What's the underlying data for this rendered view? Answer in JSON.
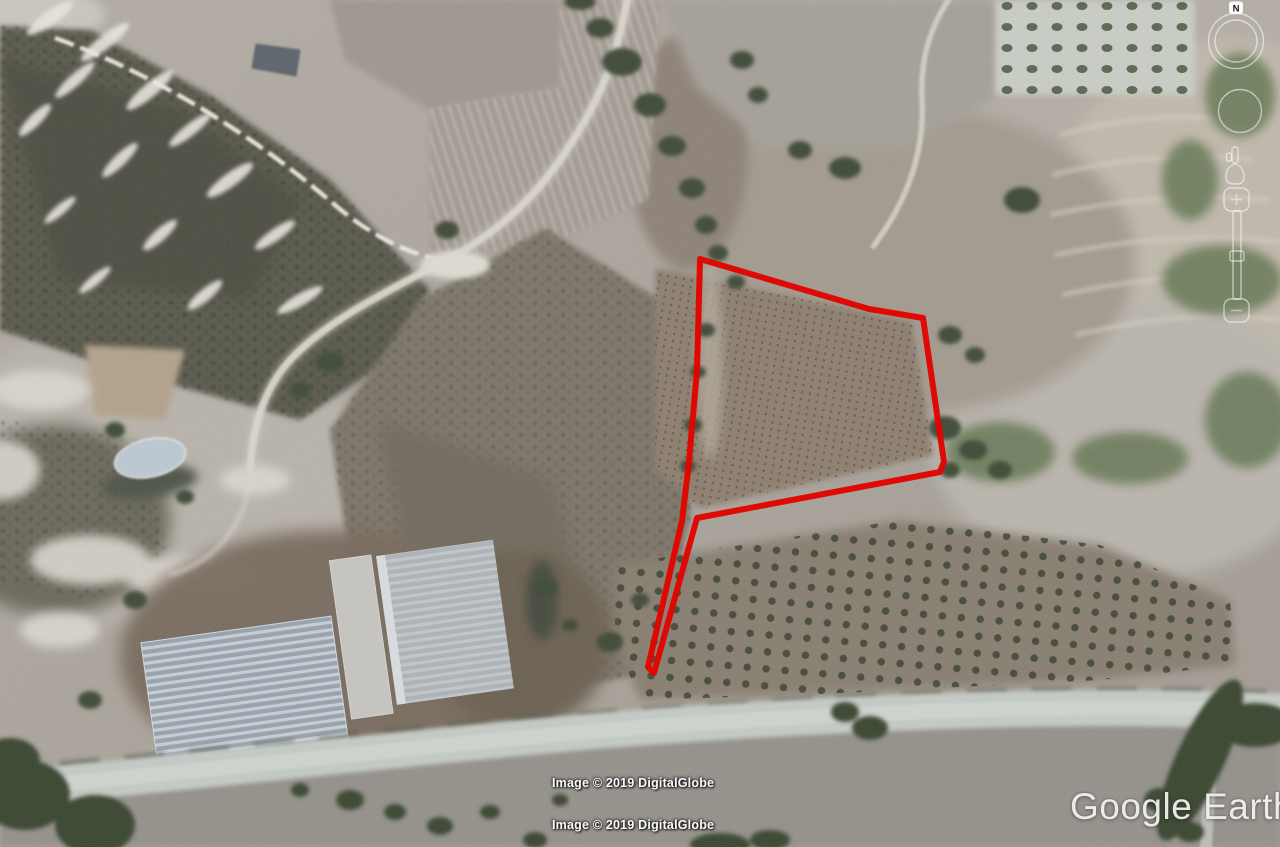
{
  "app": {
    "name": "Google Earth"
  },
  "viewer": {
    "logo_text": "Google Earth",
    "attribution": [
      "Image © 2019 DigitalGlobe",
      "Image © 2019 DigitalGlobe"
    ]
  },
  "parcel": {
    "description": "red land-parcel boundary overlay with narrow access sliver at south-west",
    "color": "#e10500",
    "stroke_width": 6,
    "points": "700,259 869,309 923,318 944,462 940,472 697,518 654,673 648,667 682,521 689,462 697,370"
  },
  "navigation": {
    "compass_label": "N"
  }
}
